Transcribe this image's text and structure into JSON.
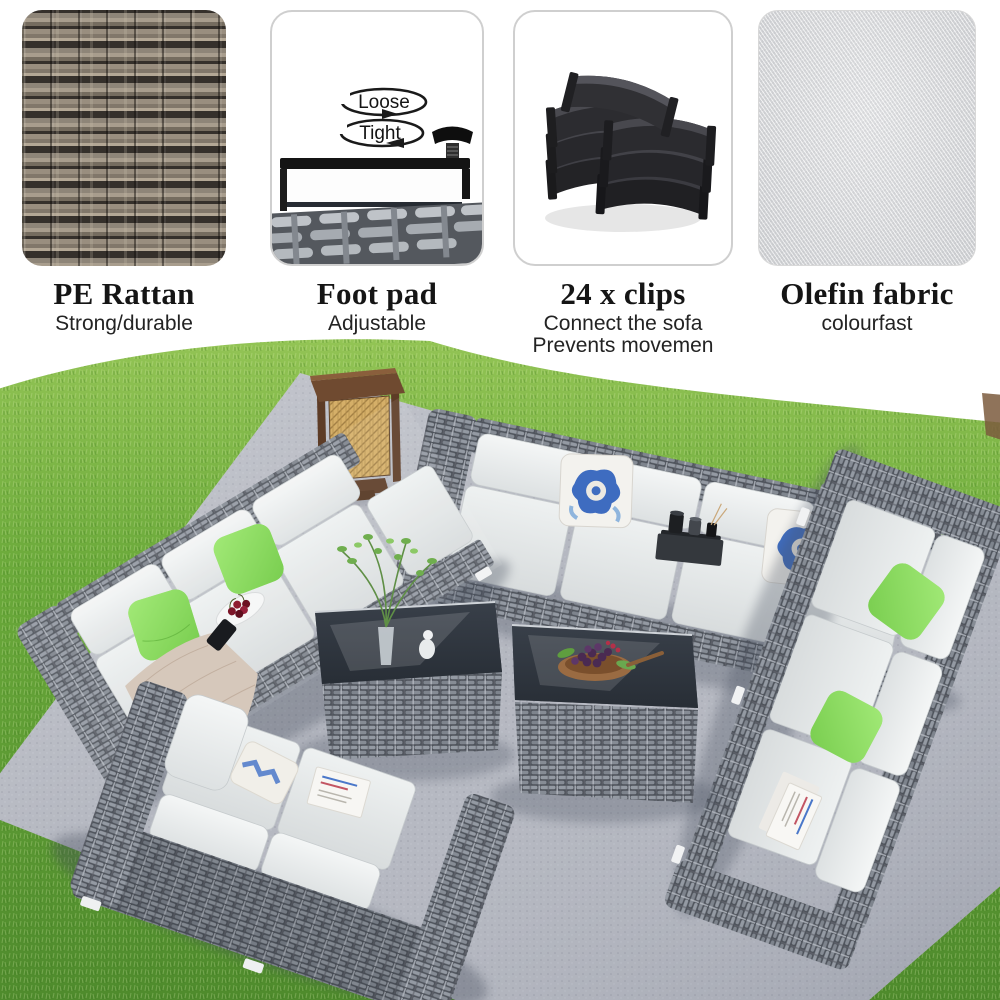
{
  "features": [
    {
      "title": "PE Rattan",
      "subtitle": "Strong/durable",
      "swatch": "rattan-weave-photo"
    },
    {
      "title": "Foot pad",
      "subtitle": "Adjustable",
      "swatch": "foot-pad-diagram",
      "diagram": {
        "loose": "Loose",
        "tight": "Tight"
      }
    },
    {
      "title": "24 x clips",
      "subtitle": "Connect the sofa",
      "subtitle2": "Prevents movemen",
      "swatch": "connector-clips-photo"
    },
    {
      "title": "Olefin fabric",
      "subtitle": "colourfast",
      "swatch": "olefin-fabric-photo"
    }
  ],
  "scene": {
    "objects": [
      "grass-lawn",
      "grey-outdoor-rug",
      "left-rattan-sofa",
      "back-rattan-sofa",
      "right-rattan-sofa",
      "front-loveseat",
      "floor-lantern",
      "coffee-table-vase",
      "coffee-table-fruit-bowl",
      "green-throw-pillows",
      "blue-pattern-pillows",
      "beige-blanket",
      "cherry-plate",
      "candle-tray",
      "magazines"
    ],
    "colors": {
      "grass": "#67a637",
      "rug": "#b4b7c0",
      "rattan": "#7d838c",
      "rattan_dark": "#565b63",
      "cushion": "#e9eceb",
      "pillow_green": "#8ddf63",
      "pillow_blue": "#3e6cc0",
      "lantern": "#6f4a30",
      "lantern_screen": "#c9a35f",
      "table_glass": "#31373f",
      "blanket": "#d6c8bb",
      "dirt": "#7b5a3d"
    }
  }
}
